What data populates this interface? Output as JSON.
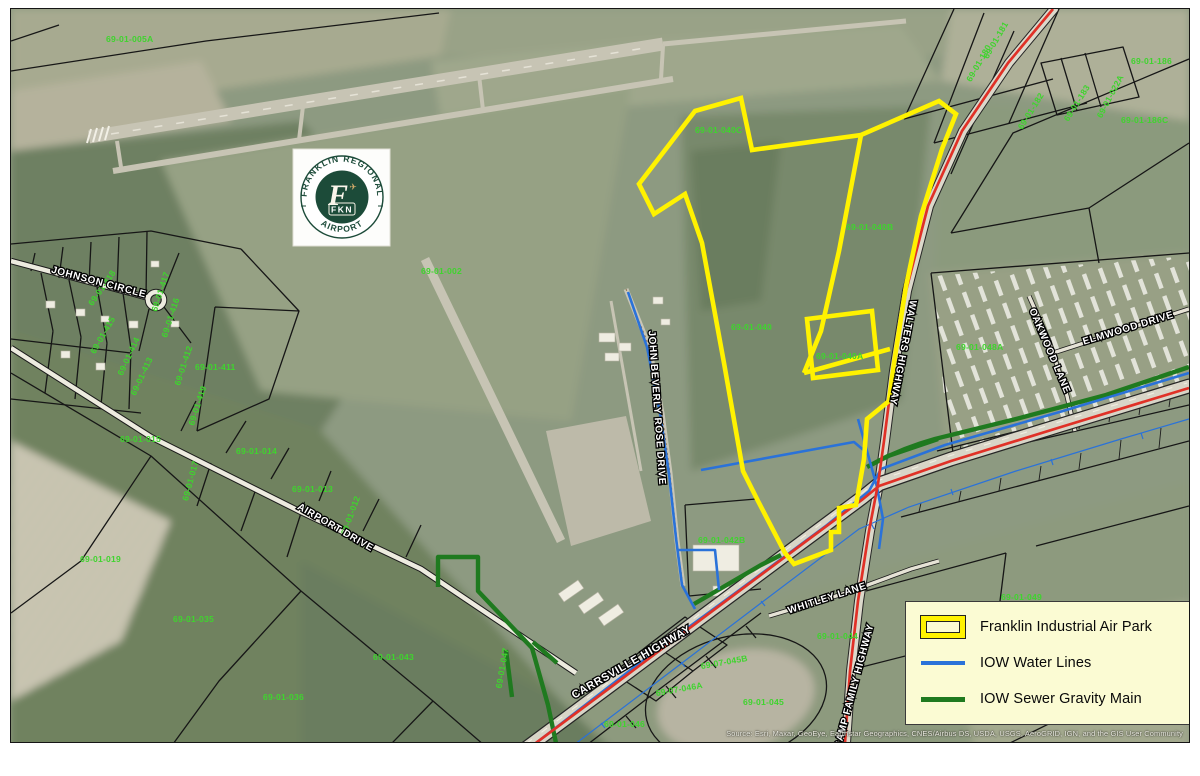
{
  "frame": {
    "attribution": "Source: Esri, Maxar, GeoEye, Earthstar Geographics, CNES/Airbus DS, USDA, USGS, AeroGRID, IGN, and the GIS User Community"
  },
  "logo": {
    "arc_top": "FRANKLIN REGIONAL",
    "arc_bottom": "AIRPORT",
    "monogram": "F",
    "code": "FKN",
    "plane": "✈"
  },
  "legend": {
    "items": [
      {
        "label": "Franklin Industrial Air Park",
        "color": "#FFF200",
        "type": "polygon-outline"
      },
      {
        "label": "IOW Water Lines",
        "color": "#2A72D9",
        "type": "line"
      },
      {
        "label": "IOW Sewer Gravity Main",
        "color": "#1F7A1F",
        "type": "line"
      }
    ]
  },
  "roads": [
    "JOHNSON CIRCLE",
    "AIRPORT DRIVE",
    "JOHN BEVERLY ROSE DRIVE",
    "WALTERS HIGHWAY",
    "OAKWOOD LANE",
    "ELMWOOD DRIVE",
    "CARRSVILLE HIGHWAY",
    "WHITLEY LANE",
    "CAMP FAMILY HIGHWAY"
  ],
  "parcels": [
    "69-01-005A",
    "69-01-186",
    "69-01-186C",
    "69-01-002",
    "69-01-040C",
    "69-01-040B",
    "69-01-040",
    "69-01-040A",
    "69-01-048A",
    "69-01-042B",
    "69-07-045B",
    "69-07-046A",
    "69-01-045",
    "69-01-044",
    "69-01-046",
    "69-01-036",
    "69-01-043",
    "69-01-035",
    "69-01-411",
    "69-01-015",
    "69-01-019",
    "69-01-014",
    "69-01-013",
    "69-01-049",
    "69-01-418",
    "69-01-417",
    "69-01-416",
    "69-01-415",
    "69-01-414",
    "69-01-413",
    "69-01-412",
    "69-01-419",
    "69-01-012",
    "69-01-017",
    "69-01-047",
    "69-01-181",
    "69-01-180",
    "69-01-022A",
    "69-01-182",
    "69-01-183"
  ],
  "colors": {
    "park_outline": "#FFF200",
    "water": "#2A72D9",
    "sewer": "#1F7A1F",
    "highway": "#E03127",
    "parcel_label": "#3FD42E",
    "legend_bg": "#FBFBD3"
  }
}
